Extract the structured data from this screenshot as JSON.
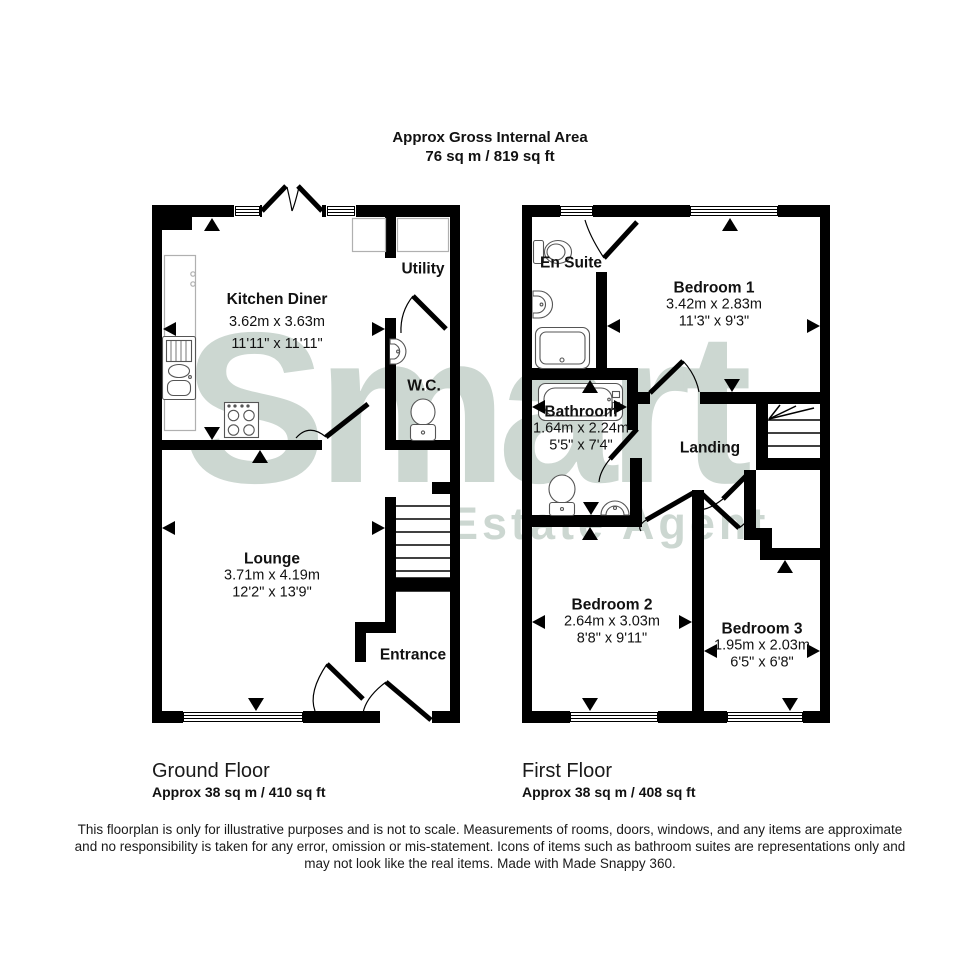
{
  "header": {
    "title": "Approx Gross Internal Area",
    "area": "76 sq m / 819 sq ft"
  },
  "watermark": {
    "brand": "Smart",
    "tagline": "Estate Agent"
  },
  "ground_floor": {
    "title": "Ground Floor",
    "area": "Approx 38 sq m / 410 sq ft",
    "rooms": {
      "kitchen_diner": {
        "name": "Kitchen Diner",
        "metric": "3.62m x 3.63m",
        "imperial": "11'11\" x 11'11\""
      },
      "utility": {
        "name": "Utility"
      },
      "wc": {
        "name": "W.C."
      },
      "lounge": {
        "name": "Lounge",
        "metric": "3.71m x 4.19m",
        "imperial": "12'2\" x 13'9\""
      },
      "entrance": {
        "name": "Entrance"
      }
    }
  },
  "first_floor": {
    "title": "First Floor",
    "area": "Approx 38 sq m / 408 sq ft",
    "rooms": {
      "en_suite": {
        "name": "En Suite"
      },
      "bedroom1": {
        "name": "Bedroom 1",
        "metric": "3.42m x 2.83m",
        "imperial": "11'3\" x 9'3\""
      },
      "bathroom": {
        "name": "Bathroom",
        "metric": "1.64m x 2.24m",
        "imperial": "5'5\" x 7'4\""
      },
      "landing": {
        "name": "Landing"
      },
      "bedroom2": {
        "name": "Bedroom 2",
        "metric": "2.64m x 3.03m",
        "imperial": "8'8\" x 9'11\""
      },
      "bedroom3": {
        "name": "Bedroom 3",
        "metric": "1.95m x 2.03m",
        "imperial": "6'5\" x 6'8\""
      }
    }
  },
  "footer": {
    "line1": "This floorplan is only for illustrative purposes and is not to scale. Measurements of rooms, doors, windows, and any items are approximate",
    "line2": "and no responsibility is taken for any error, omission or mis-statement. Icons of items such as bathroom suites are representations only and",
    "line3": "may not look like the real items. Made with Made Snappy 360."
  },
  "colors": {
    "wall": "#000000",
    "watermark": "#ccd7d1",
    "fixture": "#555555",
    "counter": "#b0b0b0"
  }
}
